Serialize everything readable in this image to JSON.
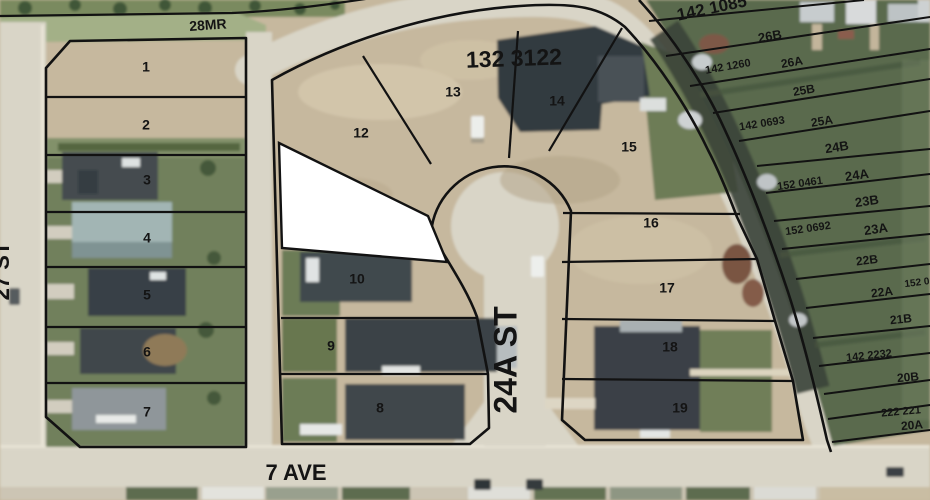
{
  "map_title": "Aerial subdivision plat map",
  "streets": {
    "bottom_avenue": "7 AVE",
    "cul_de_sac_street": "24A ST",
    "left_street": "27 ST",
    "municipal_reserve": "28MR"
  },
  "plan_numbers": {
    "main_block": "132 3122",
    "top_right": "142 1085",
    "east_block": [
      "142 1260",
      "142 0693",
      "152 0461",
      "152 0692",
      "152 0",
      "142 2232",
      "222 221"
    ]
  },
  "blocks": {
    "west_block_lots": [
      "1",
      "2",
      "3",
      "4",
      "5",
      "6",
      "7"
    ],
    "cul_de_sac_block_lots": [
      "8",
      "9",
      "10",
      "12",
      "13",
      "14",
      "15",
      "16",
      "17",
      "18",
      "19"
    ],
    "east_block_lots": [
      "26B",
      "26A",
      "25B",
      "25A",
      "24B",
      "24A",
      "23B",
      "23A",
      "22B",
      "22A",
      "21B",
      "20B",
      "20A"
    ]
  },
  "colors": {
    "plat_line": "#121212",
    "road": "#d9d5c7",
    "dirt": "#c6b89e",
    "grass_west": "#71805b",
    "grass_east": "#5a6a4e",
    "roof_dark": "#3c4348",
    "masked_lot": "#ffffff"
  },
  "labels": [
    {
      "name": "label-28mr",
      "text": "28MR",
      "x": 208,
      "y": 26,
      "rot": -4,
      "size": 14,
      "w": 600
    },
    {
      "name": "label-plan-132-3122",
      "text": "132 3122",
      "x": 514,
      "y": 60,
      "rot": -2,
      "size": 23,
      "w": 600
    },
    {
      "name": "label-plan-142-1085",
      "text": "142 1085",
      "x": 712,
      "y": 9,
      "rot": -12,
      "size": 17,
      "w": 600
    },
    {
      "name": "label-street-24a-st",
      "text": "24A ST",
      "x": 508,
      "y": 360,
      "rot": -90,
      "size": 32,
      "w": 600
    },
    {
      "name": "label-street-7-ave",
      "text": "7 AVE",
      "x": 296,
      "y": 474,
      "rot": 0,
      "size": 22,
      "w": 600
    },
    {
      "name": "label-street-27-st",
      "text": "27 ST",
      "x": 3,
      "y": 271,
      "rot": -90,
      "size": 22,
      "w": 600
    },
    {
      "name": "label-lot-1",
      "text": "1",
      "x": 146,
      "y": 68,
      "rot": 0,
      "size": 14,
      "w": 600
    },
    {
      "name": "label-lot-2",
      "text": "2",
      "x": 146,
      "y": 126,
      "rot": 0,
      "size": 14,
      "w": 600
    },
    {
      "name": "label-lot-3",
      "text": "3",
      "x": 147,
      "y": 181,
      "rot": 0,
      "size": 14,
      "w": 600
    },
    {
      "name": "label-lot-4",
      "text": "4",
      "x": 147,
      "y": 239,
      "rot": 0,
      "size": 14,
      "w": 600
    },
    {
      "name": "label-lot-5",
      "text": "5",
      "x": 147,
      "y": 296,
      "rot": 0,
      "size": 14,
      "w": 600
    },
    {
      "name": "label-lot-6",
      "text": "6",
      "x": 147,
      "y": 353,
      "rot": 0,
      "size": 14,
      "w": 600
    },
    {
      "name": "label-lot-7",
      "text": "7",
      "x": 147,
      "y": 413,
      "rot": 0,
      "size": 14,
      "w": 600
    },
    {
      "name": "label-lot-8",
      "text": "8",
      "x": 380,
      "y": 409,
      "rot": 0,
      "size": 14,
      "w": 600
    },
    {
      "name": "label-lot-9",
      "text": "9",
      "x": 331,
      "y": 347,
      "rot": 0,
      "size": 14,
      "w": 600
    },
    {
      "name": "label-lot-10",
      "text": "10",
      "x": 357,
      "y": 280,
      "rot": 0,
      "size": 14,
      "w": 600
    },
    {
      "name": "label-lot-12",
      "text": "12",
      "x": 361,
      "y": 134,
      "rot": 0,
      "size": 14,
      "w": 600
    },
    {
      "name": "label-lot-13",
      "text": "13",
      "x": 453,
      "y": 93,
      "rot": 0,
      "size": 14,
      "w": 600
    },
    {
      "name": "label-lot-14",
      "text": "14",
      "x": 557,
      "y": 102,
      "rot": 0,
      "size": 14,
      "w": 600
    },
    {
      "name": "label-lot-15",
      "text": "15",
      "x": 629,
      "y": 148,
      "rot": 0,
      "size": 14,
      "w": 600
    },
    {
      "name": "label-lot-16",
      "text": "16",
      "x": 651,
      "y": 224,
      "rot": 0,
      "size": 14,
      "w": 600
    },
    {
      "name": "label-lot-17",
      "text": "17",
      "x": 667,
      "y": 289,
      "rot": 0,
      "size": 14,
      "w": 600
    },
    {
      "name": "label-lot-18",
      "text": "18",
      "x": 670,
      "y": 348,
      "rot": 0,
      "size": 14,
      "w": 600
    },
    {
      "name": "label-lot-19",
      "text": "19",
      "x": 680,
      "y": 409,
      "rot": 0,
      "size": 14,
      "w": 600
    },
    {
      "name": "label-lot-26b",
      "text": "26B",
      "x": 770,
      "y": 37,
      "rot": -10,
      "size": 13,
      "w": 600
    },
    {
      "name": "label-plan-142-1260",
      "text": "142 1260",
      "x": 728,
      "y": 67,
      "rot": -10,
      "size": 11,
      "w": 600
    },
    {
      "name": "label-lot-26a",
      "text": "26A",
      "x": 792,
      "y": 63,
      "rot": -10,
      "size": 12,
      "w": 600
    },
    {
      "name": "label-lot-25b",
      "text": "25B",
      "x": 804,
      "y": 91,
      "rot": -10,
      "size": 12,
      "w": 600
    },
    {
      "name": "label-plan-142-0693",
      "text": "142 0693",
      "x": 762,
      "y": 124,
      "rot": -9,
      "size": 11,
      "w": 600
    },
    {
      "name": "label-lot-25a",
      "text": "25A",
      "x": 822,
      "y": 122,
      "rot": -9,
      "size": 12,
      "w": 600
    },
    {
      "name": "label-lot-24b",
      "text": "24B",
      "x": 837,
      "y": 148,
      "rot": -9,
      "size": 13,
      "w": 600
    },
    {
      "name": "label-plan-152-0461",
      "text": "152 0461",
      "x": 800,
      "y": 184,
      "rot": -8,
      "size": 11,
      "w": 600
    },
    {
      "name": "label-lot-24a",
      "text": "24A",
      "x": 857,
      "y": 176,
      "rot": -8,
      "size": 13,
      "w": 600
    },
    {
      "name": "label-lot-23b",
      "text": "23B",
      "x": 867,
      "y": 202,
      "rot": -8,
      "size": 13,
      "w": 600
    },
    {
      "name": "label-plan-152-0692",
      "text": "152 0692",
      "x": 808,
      "y": 229,
      "rot": -8,
      "size": 11,
      "w": 600
    },
    {
      "name": "label-lot-23a",
      "text": "23A",
      "x": 876,
      "y": 230,
      "rot": -8,
      "size": 13,
      "w": 600
    },
    {
      "name": "label-lot-22b",
      "text": "22B",
      "x": 867,
      "y": 261,
      "rot": -7,
      "size": 12,
      "w": 600
    },
    {
      "name": "label-plan-152-0-partial",
      "text": "152 0",
      "x": 917,
      "y": 283,
      "rot": -7,
      "size": 10,
      "w": 600
    },
    {
      "name": "label-lot-22a",
      "text": "22A",
      "x": 882,
      "y": 293,
      "rot": -7,
      "size": 12,
      "w": 600
    },
    {
      "name": "label-lot-21b",
      "text": "21B",
      "x": 901,
      "y": 320,
      "rot": -6,
      "size": 12,
      "w": 600
    },
    {
      "name": "label-plan-142-2232",
      "text": "142 2232",
      "x": 869,
      "y": 356,
      "rot": -6,
      "size": 11,
      "w": 600
    },
    {
      "name": "label-lot-20b",
      "text": "20B",
      "x": 908,
      "y": 378,
      "rot": -5,
      "size": 12,
      "w": 600
    },
    {
      "name": "label-plan-222-221",
      "text": "222 221",
      "x": 901,
      "y": 412,
      "rot": -5,
      "size": 11,
      "w": 600
    },
    {
      "name": "label-lot-20a",
      "text": "20A",
      "x": 912,
      "y": 426,
      "rot": -5,
      "size": 12,
      "w": 600
    }
  ]
}
